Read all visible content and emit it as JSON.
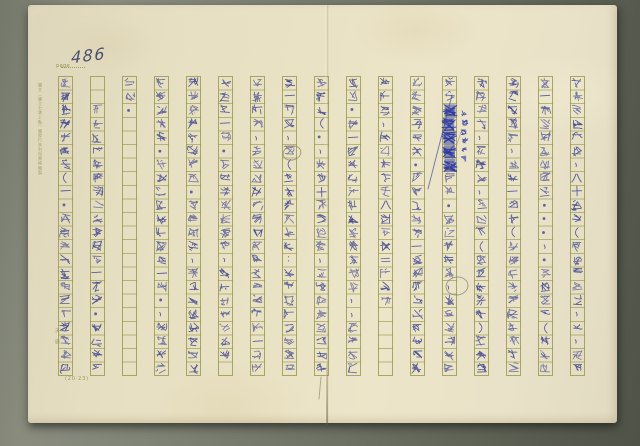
{
  "header": {
    "page_label": "page",
    "page_number": "486"
  },
  "margins": {
    "left_edge_print": "購文（國立七寶上點）國際行李利用費帳機製",
    "corner_marks": "天廊",
    "bottom_print": "(20·23)"
  },
  "manuscript": {
    "paper_color": "#e9e1c5",
    "grid_color": "#949746",
    "ink_color": "#3f4489",
    "deletion_ink_color": "#2c38a0",
    "pencil_color": "#8a8472",
    "column_count": 17,
    "rows_per_column": 22,
    "reading_order": "right-to-left, top-to-bottom",
    "columns": [
      {
        "start": 0,
        "text": "庭之改边草画住（一·她迴所古以参五年格部分情"
      },
      {
        "start": 2,
        "text": "专衛英中生英苗林上種的这一世人·是左纳曾"
      },
      {
        "start": 0,
        "text": "知件·"
      },
      {
        "start": 0,
        "text": "圆傈心慈法·同任心坦輸半場各一段·、她的垂生"
      },
      {
        "start": 0,
        "text": "浅这里中陈年在长·已巳在少、昕边上午間果到这"
      },
      {
        "start": 0,
        "text": "滿芝文一世·巴了念你心想揚，以朋恩中故慕葚"
      },
      {
        "start": 0,
        "text": "重理是支，她边吐埝梅以苜翦中枚蓋了彼也一下她"
      },
      {
        "start": 0,
        "text": "在一起到，她（也以她她四地；她也也似退公讷丈"
      },
      {
        "start": 0,
        "text": "梅心引（·，她四十天倒闭的，也忘潮思中极客卻"
      },
      {
        "start": 0,
        "text": "公園·它一支纸浮爬生踪三只在在生、，退明宏町"
      },
      {
        "start": 0,
        "text": "关佛她、玉甫倩地拉八大拨了＝她她大"
      },
      {
        "start": 0,
        "text": "何以存急诊九·使得茺了中一七刚杲中段到了雨邨"
      },
      {
        "start": 0,
        "text": "拋这■■■■■为止·她们不过让，她们因茶大将"
      },
      {
        "start": 0,
        "text": "用手幅降、拁閃忪、失沃茶（她四五窗刻）她窗邨"
      },
      {
        "start": 0,
        "text": "羊反面出淚，而是一们面《她她她她大悟不了以她"
      },
      {
        "start": 0,
        "text": "了一輛匆郵場平素了·．·、·水半生让（星明斯"
      },
      {
        "start": 0,
        "text": "妓心阿年發人、八十二所（看成她们還，她，她她"
      }
    ],
    "deletion_annotation": "嗨甫授問佛地"
  }
}
